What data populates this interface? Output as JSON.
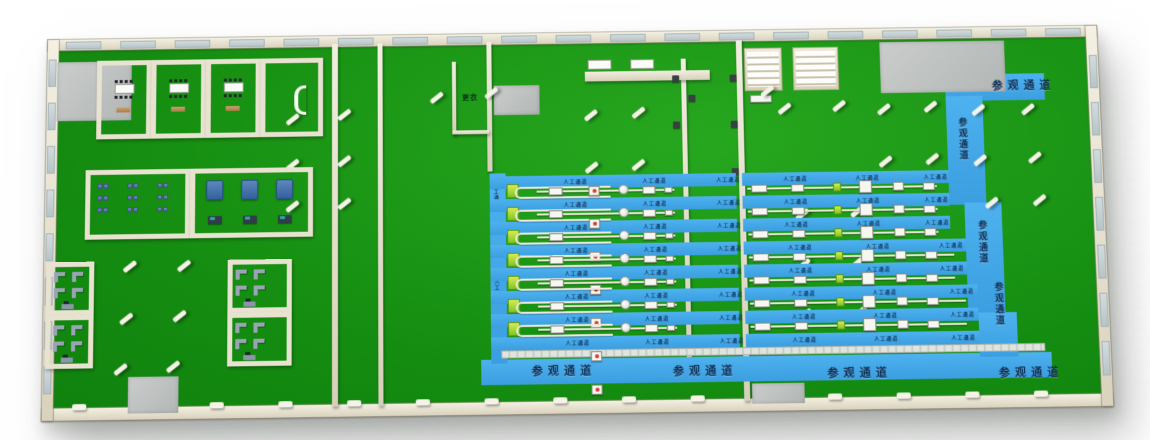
{
  "title": "factory-workshop-3d-floor-plan",
  "labels": {
    "visitor_corridor": "参观通道",
    "worker_corridor": "人工通道",
    "changing_room": "更衣"
  },
  "colors": {
    "floor_green": "#148c10",
    "corridor_blue": "#41a8ea",
    "wall_cream": "#ece7d6",
    "gray_floor": "#bfc3c2",
    "label_navy": "#0c2c52",
    "machine_green": "#7ec626",
    "machine_blue": "#34619c",
    "accent_red": "#d43a2a"
  },
  "structure": {
    "window_counts": {
      "top": 19,
      "left": 8,
      "right": 7,
      "bottom_posts": 15
    },
    "gray_patches": [
      [
        10,
        23,
        75,
        60
      ],
      [
        450,
        53,
        46,
        30
      ],
      [
        85,
        340,
        50,
        36
      ],
      [
        703,
        355,
        52,
        20
      ],
      [
        840,
        14,
        126,
        52
      ]
    ],
    "pillars": [
      [
        240,
        82
      ],
      [
        292,
        78
      ],
      [
        240,
        128
      ],
      [
        292,
        125
      ],
      [
        240,
        170
      ],
      [
        292,
        168
      ],
      [
        385,
        62
      ],
      [
        440,
        58
      ],
      [
        540,
        82
      ],
      [
        588,
        80
      ],
      [
        540,
        135
      ],
      [
        587,
        133
      ],
      [
        78,
        228
      ],
      [
        132,
        228
      ],
      [
        75,
        280
      ],
      [
        128,
        278
      ],
      [
        70,
        330
      ],
      [
        122,
        328
      ],
      [
        718,
        60
      ],
      [
        735,
        78
      ],
      [
        790,
        76
      ],
      [
        835,
        80
      ],
      [
        882,
        78
      ],
      [
        930,
        82
      ],
      [
        980,
        82
      ],
      [
        835,
        133
      ],
      [
        882,
        131
      ],
      [
        930,
        133
      ],
      [
        985,
        131
      ],
      [
        940,
        176
      ],
      [
        988,
        174
      ],
      [
        750,
        185
      ],
      [
        805,
        183
      ],
      [
        750,
        235
      ],
      [
        805,
        233
      ],
      [
        750,
        285
      ],
      [
        805,
        283
      ]
    ],
    "halls": {
      "left": {
        "strip_x": 445,
        "strip_w": 247,
        "strip_y0": 145,
        "strip_h": 13,
        "pitch": 23,
        "strips": 8,
        "line_x": 462,
        "line_w": 168,
        "lines": 7
      },
      "right": {
        "strip_x": 698,
        "strip_y0": 145,
        "strip_h": 13,
        "pitch": 23,
        "strips": 8,
        "lines": 7,
        "line_x": 703,
        "ends": [
          905,
          905,
          905,
          920,
          920,
          930,
          930
        ]
      }
    },
    "worker_label_fracs_left": [
      0.3,
      0.62,
      0.92
    ],
    "worker_label_fracs_right": [
      0.2,
      0.55,
      0.88
    ],
    "vertical_worker_labels": [
      [
        445,
        152
      ],
      [
        445,
        248
      ]
    ],
    "visitor_labels": [
      {
        "x": 952,
        "y": 52,
        "vertical": false
      },
      {
        "x": 914,
        "y": 92,
        "vertical": true
      },
      {
        "x": 930,
        "y": 196,
        "vertical": true
      },
      {
        "x": 944,
        "y": 258,
        "vertical": true
      },
      {
        "x": 485,
        "y": 332,
        "vertical": false
      },
      {
        "x": 625,
        "y": 334,
        "vertical": false
      },
      {
        "x": 778,
        "y": 338,
        "vertical": false
      },
      {
        "x": 948,
        "y": 340,
        "vertical": false
      }
    ],
    "meeting_rooms": [
      [
        50,
        22,
        55,
        80
      ],
      [
        105,
        22,
        55,
        80
      ],
      [
        160,
        22,
        55,
        80
      ]
    ],
    "reception_room": [
      215,
      22,
      63,
      80
    ],
    "rack_room": [
      40,
      133,
      105,
      70
    ],
    "machine_room": [
      145,
      133,
      123,
      70
    ],
    "office_rooms": [
      [
        2,
        225,
        48,
        53
      ],
      [
        2,
        278,
        48,
        53
      ],
      [
        183,
        225,
        64,
        53
      ],
      [
        183,
        278,
        64,
        53
      ]
    ],
    "changing_room": [
      408,
      28,
      37,
      74
    ]
  }
}
